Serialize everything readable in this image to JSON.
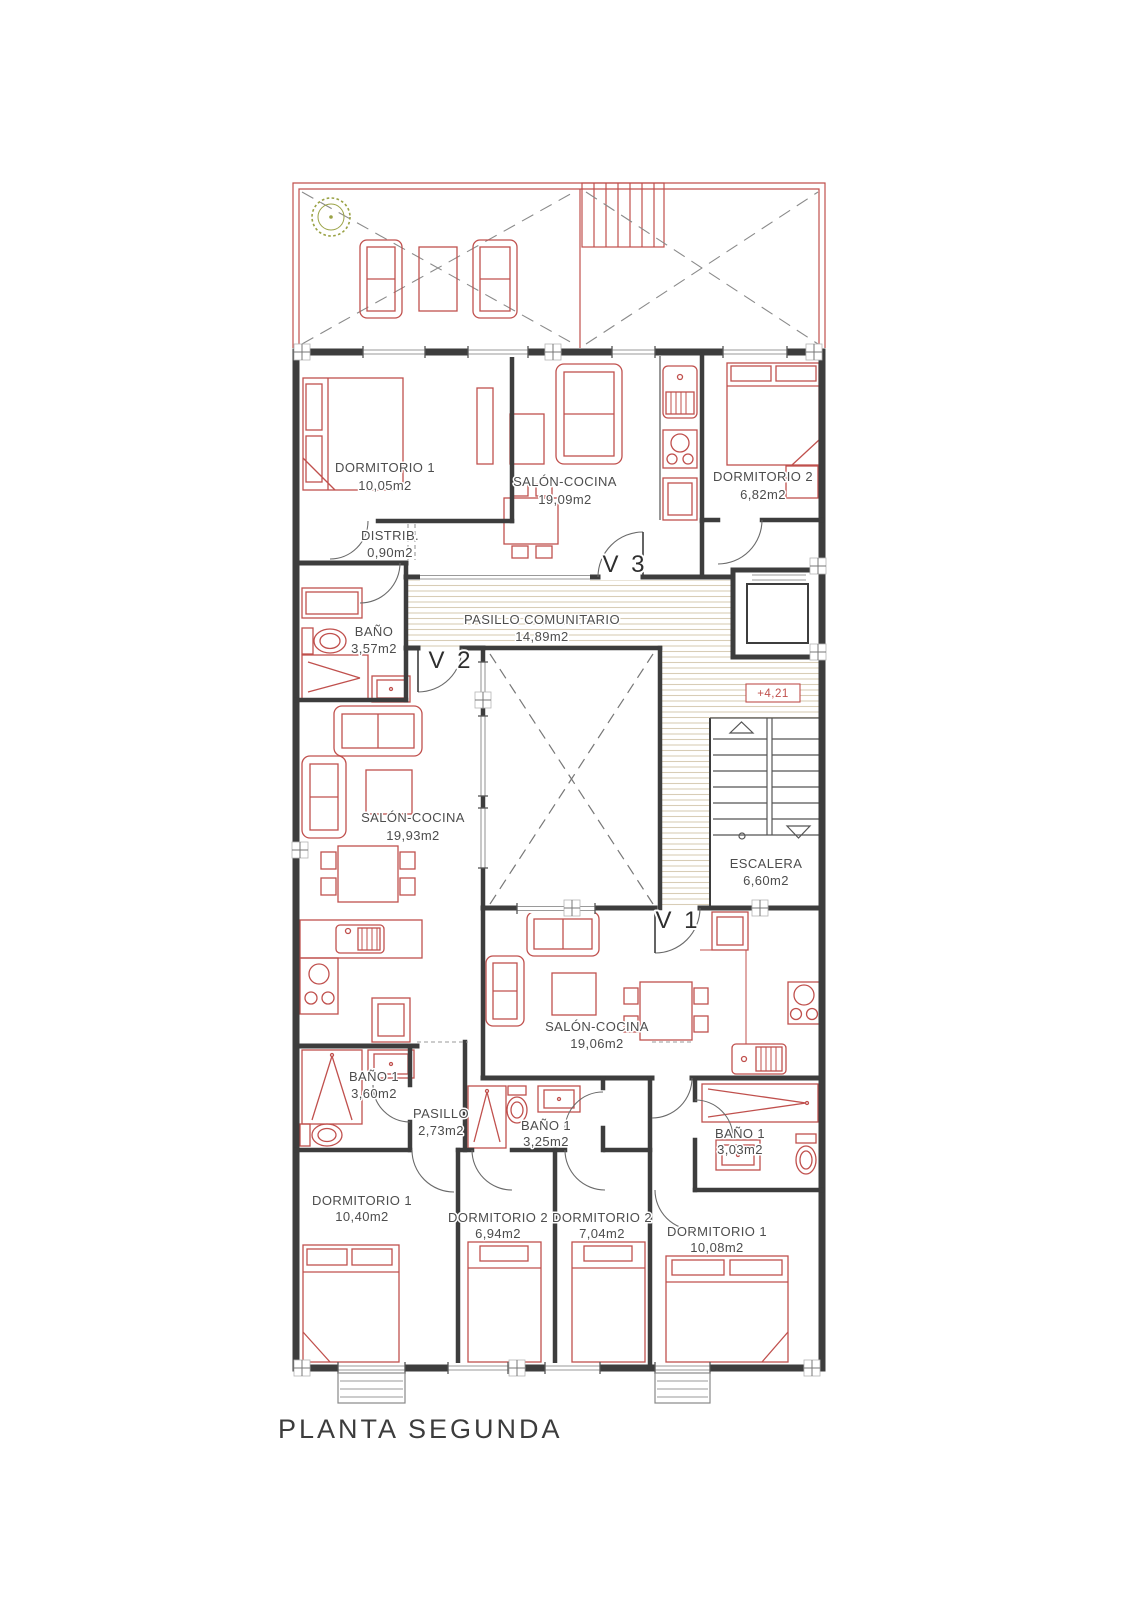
{
  "title": "PLANTA SEGUNDA",
  "colors": {
    "wall": "#3d3d3d",
    "furniture": "#c0504d",
    "hatch": "#d8cdb6",
    "text": "#4d4d4d",
    "tree": "#9aa245",
    "level_marker": "#c0504d"
  },
  "rooms": {
    "dorm1_top": {
      "name": "DORMITORIO 1",
      "area": "10,05m2"
    },
    "salon_top": {
      "name": "SALÓN-COCINA",
      "area": "19,09m2"
    },
    "dorm2_top": {
      "name": "DORMITORIO 2",
      "area": "6,82m2"
    },
    "distrib": {
      "name": "DISTRIB.",
      "area": "0,90m2"
    },
    "bano_top": {
      "name": "BAÑO",
      "area": "3,57m2"
    },
    "pasillo_comunitario": {
      "name": "PASILLO COMUNITARIO",
      "area": "14,89m2"
    },
    "salon_mid": {
      "name": "SALÓN-COCINA",
      "area": "19,93m2"
    },
    "escalera": {
      "name": "ESCALERA",
      "area": "6,60m2"
    },
    "salon_bottom": {
      "name": "SALÓN-COCINA",
      "area": "19,06m2"
    },
    "bano1_left": {
      "name": "BAÑO 1",
      "area": "3,60m2"
    },
    "pasillo": {
      "name": "PASILLO",
      "area": "2,73m2"
    },
    "bano1_mid": {
      "name": "BAÑO 1",
      "area": "3,25m2"
    },
    "bano1_right": {
      "name": "BAÑO 1",
      "area": "3,03m2"
    },
    "dorm1_bl": {
      "name": "DORMITORIO 1",
      "area": "10,40m2"
    },
    "dorm2_bl": {
      "name": "DORMITORIO 2",
      "area": "6,94m2"
    },
    "dorm2_br": {
      "name": "DORMITORIO 2",
      "area": "7,04m2"
    },
    "dorm1_br": {
      "name": "DORMITORIO 1",
      "area": "10,08m2"
    }
  },
  "markers": {
    "v1": "V 1",
    "v2": "V 2",
    "v3": "V 3",
    "level": "+4,21"
  }
}
